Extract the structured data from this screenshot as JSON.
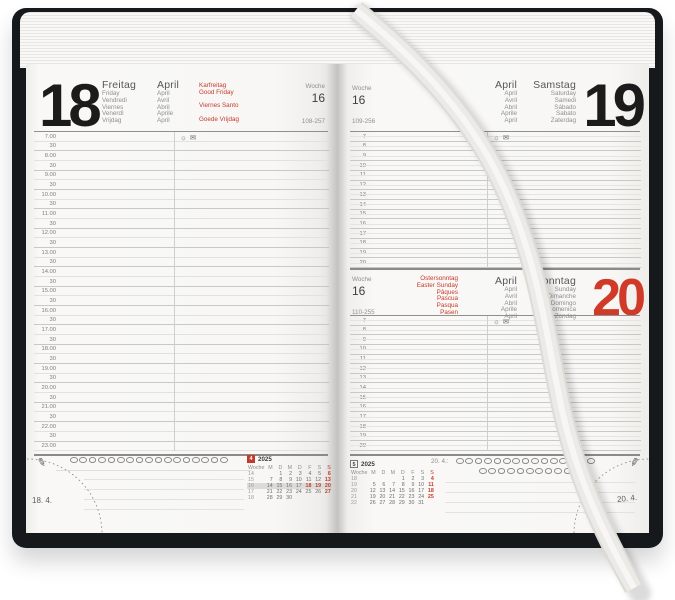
{
  "colors": {
    "accent_red": "#c43a2a",
    "cover": "#15191c",
    "ribbon": "#eceae7"
  },
  "left_page": {
    "day_number": "18",
    "week_label": "Woche",
    "week_number": "16",
    "day_of_year": "108-257",
    "day_names": [
      "Freitag",
      "Friday",
      "Vendredi",
      "Viernes",
      "Venerdì",
      "Vrijdag"
    ],
    "month_names": [
      "April",
      "April",
      "Avril",
      "Abril",
      "Aprile",
      "April"
    ],
    "holiday_names": [
      "Karfreitag",
      "Good Friday",
      "",
      "Viernes Santo",
      "",
      "Goede Vrijdag"
    ],
    "time_slots": [
      "7.00",
      "30",
      "8.00",
      "30",
      "9.00",
      "30",
      "10.00",
      "30",
      "11.00",
      "30",
      "12.00",
      "30",
      "13.00",
      "30",
      "14.00",
      "30",
      "15.00",
      "30",
      "16.00",
      "30",
      "17.00",
      "30",
      "18.00",
      "30",
      "19.00",
      "30",
      "20.00",
      "30",
      "21.00",
      "30",
      "22.00",
      "30",
      "23.00"
    ],
    "marker_count": 17,
    "note_line_count": 4,
    "mini_calendar": {
      "month_number": "4",
      "year": "2025",
      "week_col": "Woche",
      "day_headers": [
        "M",
        "D",
        "M",
        "D",
        "F",
        "S",
        "S"
      ],
      "weeks": [
        {
          "week": "14",
          "days": [
            "",
            "1",
            "2",
            "3",
            "4",
            "5",
            "6"
          ]
        },
        {
          "week": "15",
          "days": [
            "7",
            "8",
            "9",
            "10",
            "11",
            "12",
            "13"
          ]
        },
        {
          "week": "16",
          "days": [
            "14",
            "15",
            "16",
            "17",
            "18",
            "19",
            "20"
          ]
        },
        {
          "week": "17",
          "days": [
            "21",
            "22",
            "23",
            "24",
            "25",
            "26",
            "27"
          ]
        },
        {
          "week": "18",
          "days": [
            "28",
            "29",
            "30",
            "",
            "",
            "",
            ""
          ]
        }
      ],
      "highlight_week": "16",
      "accent_days": [
        "18",
        "19"
      ]
    },
    "corner_date": "18. 4."
  },
  "right_page": {
    "saturday": {
      "day_number": "19",
      "week_label": "Woche",
      "week_number": "16",
      "day_of_year": "109-256",
      "month_names": [
        "April",
        "April",
        "Avril",
        "Abril",
        "Aprile",
        "April"
      ],
      "day_names": [
        "Samstag",
        "Saturday",
        "Samedi",
        "Sábado",
        "Sabato",
        "Zaterdag"
      ],
      "hours": [
        "7",
        "8",
        "9",
        "10",
        "11",
        "12",
        "13",
        "14",
        "15",
        "16",
        "17",
        "18",
        "19",
        "20"
      ]
    },
    "sunday": {
      "day_number": "20",
      "week_label": "Woche",
      "week_number": "16",
      "day_of_year": "110-255",
      "holiday_names": [
        "Ostersonntag",
        "Easter Sunday",
        "Pâques",
        "Pascua",
        "Pasqua",
        "Pasen"
      ],
      "month_names": [
        "April",
        "April",
        "Avril",
        "Abril",
        "Aprile",
        "April"
      ],
      "day_names": [
        "Sonntag",
        "Sunday",
        "Dimanche",
        "Domingo",
        "Domenica",
        "Zondag"
      ],
      "hours": [
        "7",
        "8",
        "9",
        "10",
        "11",
        "12",
        "13",
        "14",
        "15",
        "16",
        "17",
        "18",
        "19",
        "20"
      ],
      "footer_date_label": "20. 4.:",
      "marker_row_counts": [
        15,
        11
      ],
      "note_line_count": 4,
      "mini_calendar": {
        "month_number": "5",
        "year": "2025",
        "week_col": "Woche",
        "day_headers": [
          "M",
          "D",
          "M",
          "D",
          "F",
          "S",
          "S"
        ],
        "weeks": [
          {
            "week": "18",
            "days": [
              "",
              "",
              "",
              "1",
              "2",
              "3",
              "4"
            ]
          },
          {
            "week": "19",
            "days": [
              "5",
              "6",
              "7",
              "8",
              "9",
              "10",
              "11"
            ]
          },
          {
            "week": "20",
            "days": [
              "12",
              "13",
              "14",
              "15",
              "16",
              "17",
              "18"
            ]
          },
          {
            "week": "21",
            "days": [
              "19",
              "20",
              "21",
              "22",
              "23",
              "24",
              "25"
            ]
          },
          {
            "week": "22",
            "days": [
              "26",
              "27",
              "28",
              "29",
              "30",
              "31",
              ""
            ]
          }
        ]
      },
      "corner_date": "20. 4."
    }
  }
}
